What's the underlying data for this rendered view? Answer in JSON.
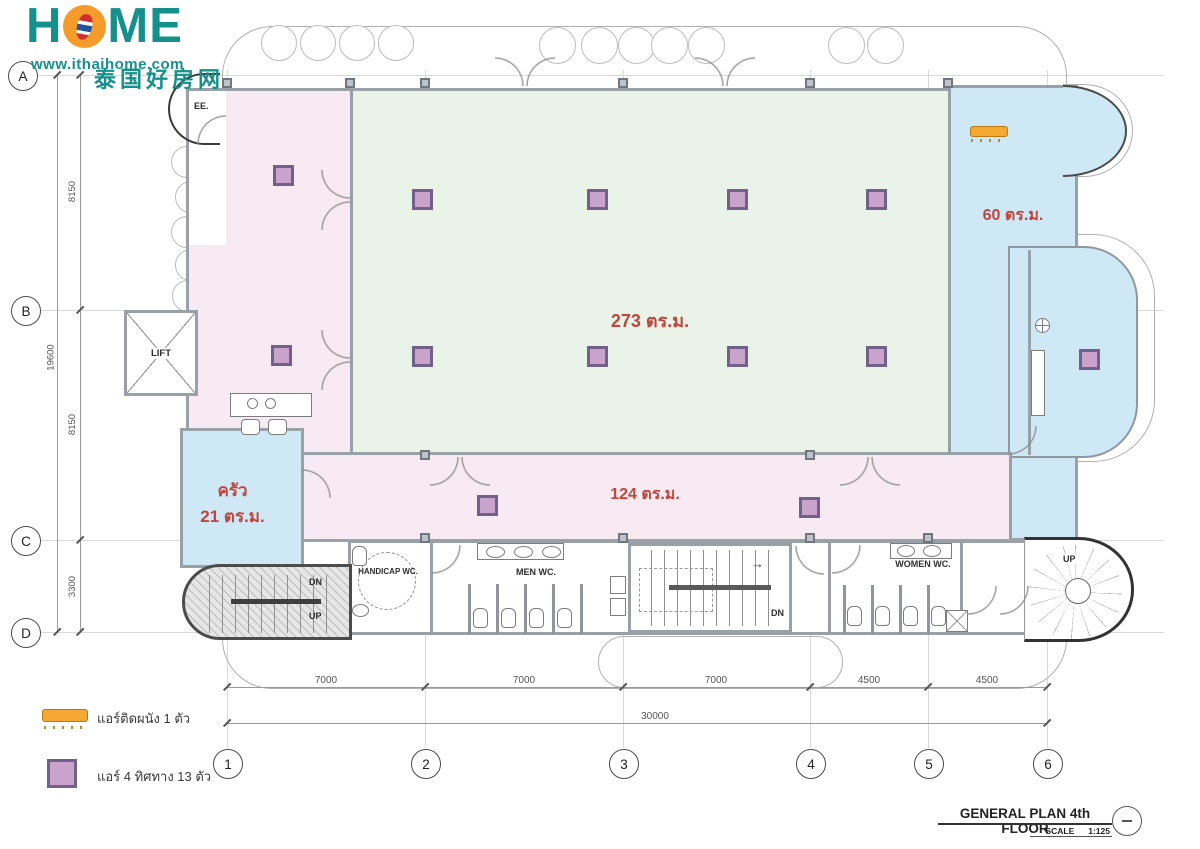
{
  "logo": {
    "home_h": "H",
    "home_me": "ME",
    "url": "www.ithaihome.com",
    "tagline": "泰国好房网"
  },
  "grid": {
    "rows": [
      "A",
      "B",
      "C",
      "D"
    ],
    "cols": [
      "1",
      "2",
      "3",
      "4",
      "5",
      "6"
    ]
  },
  "dimensions": {
    "left_total": "19600",
    "left_segments": [
      "8150",
      "8150",
      "3300"
    ],
    "bottom_segments": [
      "7000",
      "7000",
      "7000",
      "4500",
      "4500"
    ],
    "bottom_total": "30000"
  },
  "rooms": {
    "main_hall_area": "273 ตร.ม.",
    "bottom_hall_area": "124 ตร.ม.",
    "kitchen_name": "ครัว",
    "kitchen_area": "21 ตร.ม.",
    "right_room_area": "60 ตร.ม.",
    "lift": "LIFT",
    "ee": "EE.",
    "handicap_wc": "HANDICAP WC.",
    "men_wc": "MEN WC.",
    "women_wc": "WOMEN WC."
  },
  "stairs": {
    "dn": "DN",
    "up": "UP",
    "arrow_right": "→"
  },
  "legend": {
    "wall_ac_label": "แอร์ติดผนัง 1 ตัว",
    "four_way_ac_label": "แอร์ 4 ทิศทาง 13 ตัว"
  },
  "title_block": {
    "title": "GENERAL PLAN 4th FLOOR",
    "scale_label": "SCALE",
    "scale_value": "1:125"
  },
  "colors": {
    "teal": "#15908a",
    "orange": "#f59b2c",
    "label_red": "#bf453d",
    "room_green": "#eaf3e8",
    "room_pink": "#f7eaf2",
    "room_blue": "#cfe8f6",
    "ac_purple": "#c9a3cc"
  }
}
